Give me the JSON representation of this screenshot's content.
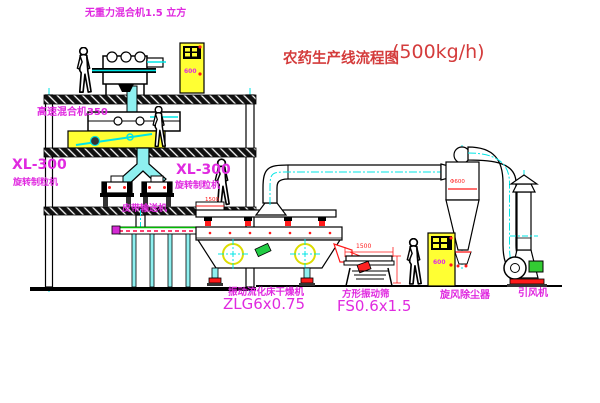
{
  "diagram": {
    "title": {
      "name": "农药生产线流程图",
      "capacity": "(500kg/h)"
    },
    "labels": {
      "gravity_mixer": "无重力混合机1.5 立方",
      "high_speed_mixer": "高速混合机350",
      "granulator_model_left": "XL-300",
      "granulator_name_left": "旋转制粒机",
      "granulator_model_right": "XL-300",
      "granulator_name_right": "旋转制粒机",
      "belt_conveyor": "皮带输送机",
      "dryer_name": "振动流化床干燥机",
      "dryer_model": "ZLG6x0.75",
      "screen_name": "方形振动筛",
      "screen_model": "FS0.6x1.5",
      "cyclone": "旋风除尘器",
      "fan": "引风机"
    },
    "dimensions": {
      "screen_length": "1500",
      "dryer_feed": "1500",
      "cyclone_diameter": "Φ600"
    },
    "cabinets": {
      "mark": "600"
    },
    "colors": {
      "label_magenta": "#E02AE0",
      "title_red": "#D43C3C",
      "cad_red": "#FF1A1A",
      "centerline_cyan": "#00E5E5",
      "cabinet_yellow": "#FFFF33",
      "motor_green": "#33CC33",
      "line_black": "#000000",
      "background": "#FFFFFF"
    }
  }
}
